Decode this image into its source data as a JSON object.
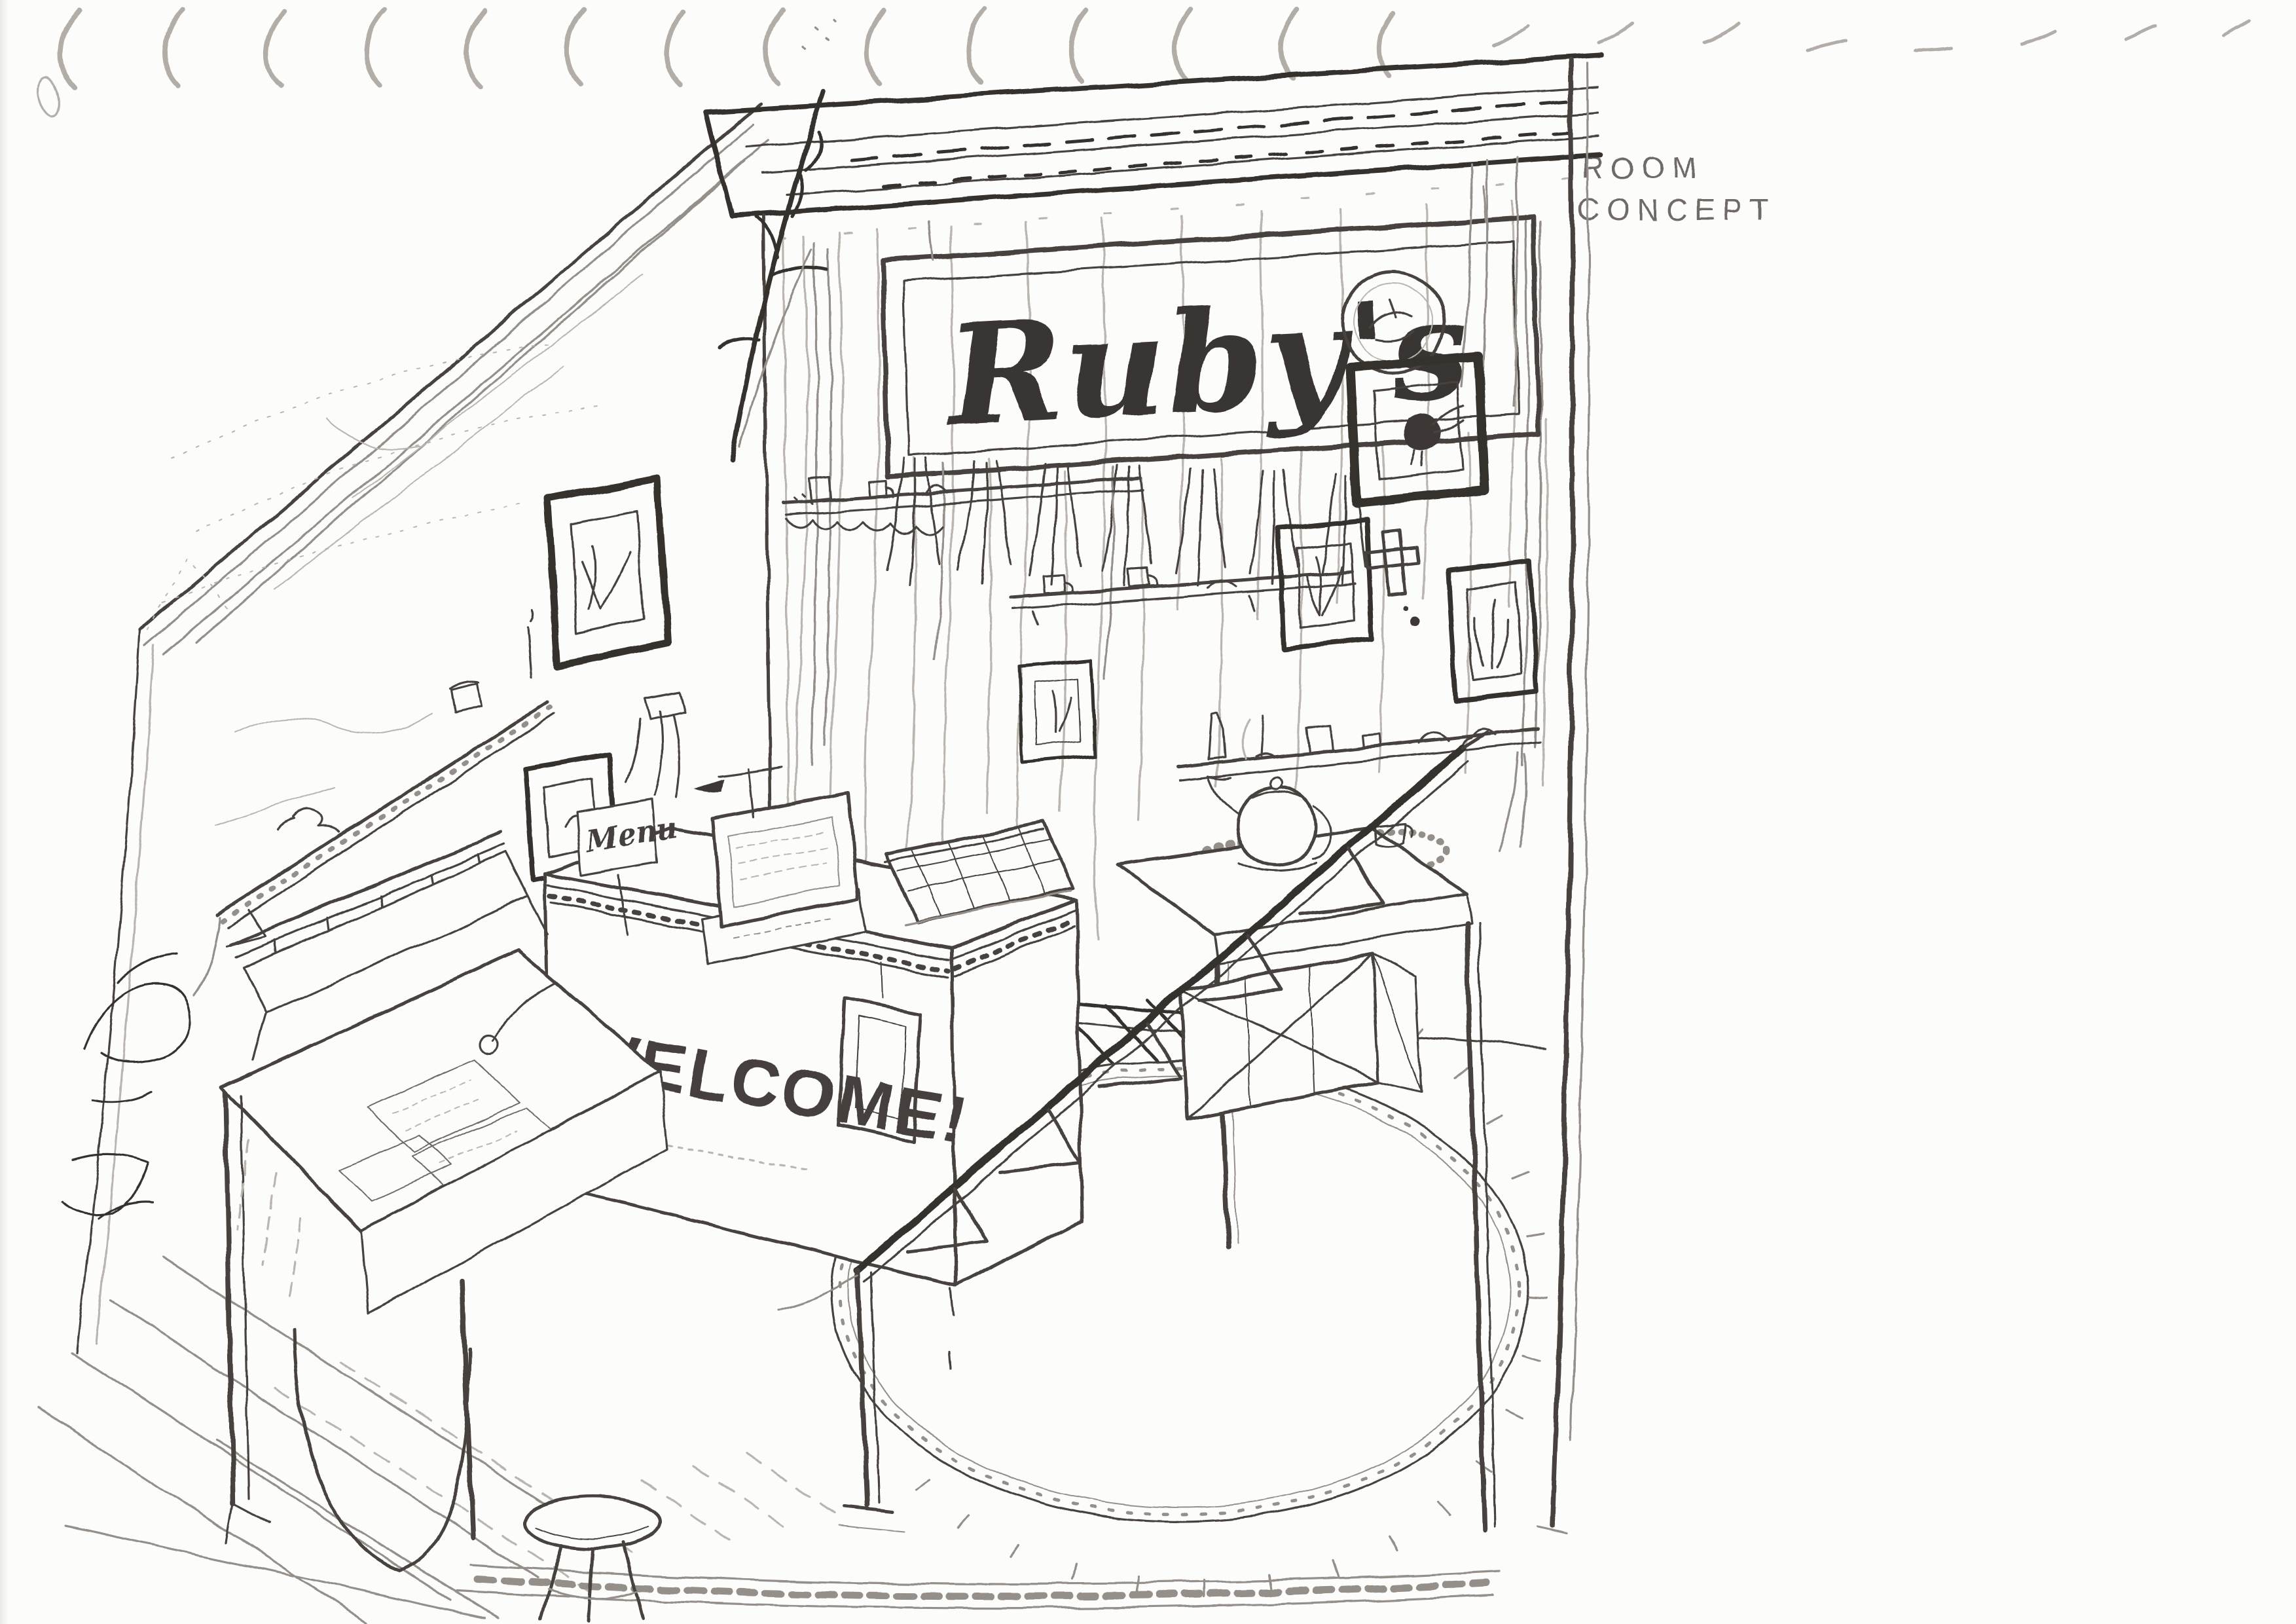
{
  "page": {
    "annotation_line1": "ROOM",
    "annotation_line2": "CONCEPT"
  },
  "sketch": {
    "sign_text": "Ruby's",
    "counter_text": "WELCOME!",
    "menu_text": "Menu"
  },
  "colors": {
    "ink": "#46423e",
    "ink_dark": "#35312d",
    "ink_faint": "#948f89",
    "paper": "#fcfcfb",
    "binding_marks": "#b2ada7",
    "annotation": "#6f6b66"
  }
}
